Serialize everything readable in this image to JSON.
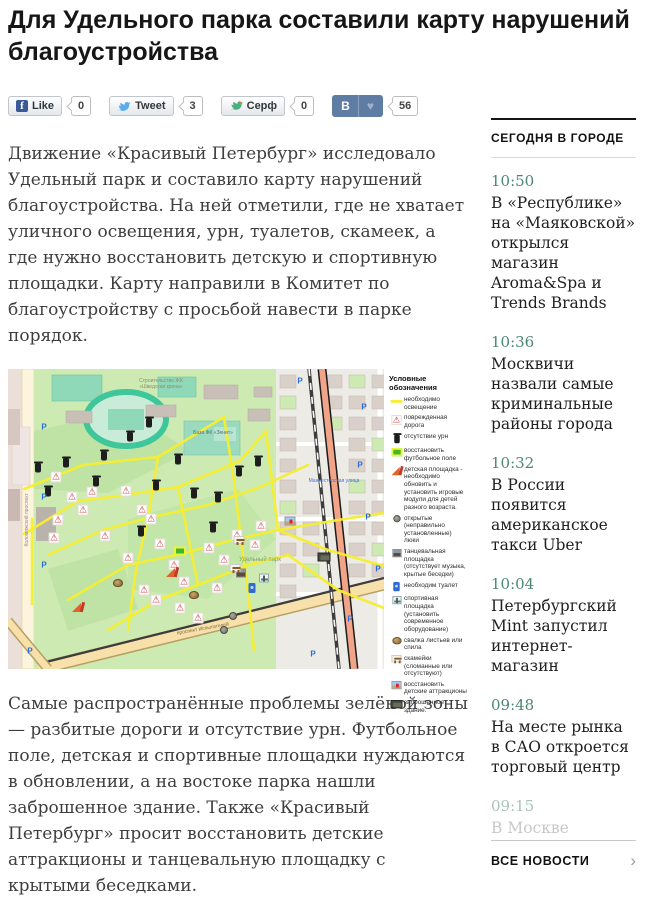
{
  "page": {
    "title": "Для Удельного парка составили карту нарушений благоустройства"
  },
  "share": {
    "facebook": {
      "label": "Like",
      "count": "0"
    },
    "twitter": {
      "label": "Tweet",
      "count": "3"
    },
    "surfingbird": {
      "label": "Серф",
      "count": "0"
    },
    "vk": {
      "label": "В",
      "count": "56"
    }
  },
  "article": {
    "paragraph_1": "Движение «Красивый Петербург» исследовало Удельный парк и составило карту нарушений благоустройства. На ней отметили, где не хватает уличного освещения, урн, туалетов, скамеек, а где нужно восстановить детскую и спортивную площадки. Карту направили в Комитет по благоустройству с просьбой навести в парке порядок.",
    "paragraph_2": "Самые распространённые проблемы зелёной зоны — разбитые дороги и отсутствие урн. Футбольное поле, детская и спортивные площадки нуждаются в обновлении, а на востоке парка нашли заброшенное здание. Также «Красивый Петербург» просит восстановить детские аттракционы и танцевальную площадку с крытыми беседками."
  },
  "map": {
    "legend_title": "Условные обозначения",
    "legend": [
      {
        "icon": "light",
        "label": "необходимо освещение"
      },
      {
        "icon": "road",
        "label": "поврежденная дорога"
      },
      {
        "icon": "urn",
        "label": "отсутствие урн"
      },
      {
        "icon": "football",
        "label": "восстановить футбольное поле"
      },
      {
        "icon": "playground",
        "label": "детская площадка - необходимо обновить и установить игровые модули для детей разного возраста."
      },
      {
        "icon": "manhole",
        "label": "открытые (неправильно установленные) люки"
      },
      {
        "icon": "dance",
        "label": "танцевальная площадка (отсутствует музыка, крытые беседки)"
      },
      {
        "icon": "toilet",
        "label": "необходим туалет"
      },
      {
        "icon": "sport",
        "label": "спортивная площадка (установить современное оборудование)"
      },
      {
        "icon": "leaves",
        "label": "свалка листьев или спила"
      },
      {
        "icon": "bench",
        "label": "скамейки (сломанные или отсутствуют)"
      },
      {
        "icon": "attraction",
        "label": "восстановить детские аттракционы"
      },
      {
        "icon": "abandoned",
        "label": "заброшенное здание."
      }
    ],
    "labels": [
      {
        "text": "Строительство ЖК «Шведская крона»",
        "x": 118,
        "y": 10,
        "w": 70,
        "size": 5,
        "color": "#8f8c70",
        "rotate": 0
      },
      {
        "text": "База ФК «Зенит»",
        "x": 180,
        "y": 62,
        "w": 50,
        "size": 5,
        "color": "#5a6a7a",
        "rotate": 0
      },
      {
        "text": "Удельный парк",
        "x": 226,
        "y": 188,
        "w": 52,
        "size": 6,
        "color": "#7f9f72",
        "rotate": 0
      },
      {
        "text": "Коломяжский проспект",
        "x": -30,
        "y": 148,
        "w": 100,
        "size": 5,
        "color": "#9a8aa5",
        "rotate": -90
      },
      {
        "text": "проспект Испытателей",
        "x": 150,
        "y": 258,
        "w": 90,
        "size": 5,
        "color": "#7a6a40",
        "rotate": -10
      },
      {
        "text": "Манчестерская улица",
        "x": 284,
        "y": 110,
        "w": 84,
        "size": 5,
        "color": "#4a6fd4",
        "rotate": 0
      }
    ],
    "parking": {
      "glyph": "P",
      "positions": [
        {
          "x": 36,
          "y": 58
        },
        {
          "x": 36,
          "y": 128
        },
        {
          "x": 36,
          "y": 196
        },
        {
          "x": 22,
          "y": 282
        },
        {
          "x": 292,
          "y": 12
        },
        {
          "x": 356,
          "y": 38
        },
        {
          "x": 352,
          "y": 96
        },
        {
          "x": 360,
          "y": 148
        },
        {
          "x": 342,
          "y": 250
        },
        {
          "x": 305,
          "y": 285
        },
        {
          "x": 370,
          "y": 200
        }
      ]
    },
    "light_paths": [
      "16,120 75,96 150,88 216,48",
      "16,165 70,132 118,126 170,118 232,92 258,62",
      "40,186 95,161 140,149 200,136 250,119 300,96",
      "60,231 120,196 168,186 225,171 270,161 330,151 376,144",
      "100,261 150,231 190,216 240,196 280,186",
      "150,88 140,149 128,201 120,261",
      "216,48 226,111 233,171 241,231 246,281",
      "170,118 190,216",
      "258,62 270,161",
      "280,186 330,221 376,239",
      "270,161 320,181 376,197",
      "24,150 24,235"
    ],
    "markers": [
      {
        "t": "road",
        "x": 48,
        "y": 108
      },
      {
        "t": "road",
        "x": 64,
        "y": 128
      },
      {
        "t": "road",
        "x": 84,
        "y": 123
      },
      {
        "t": "road",
        "x": 75,
        "y": 141
      },
      {
        "t": "road",
        "x": 50,
        "y": 151
      },
      {
        "t": "road",
        "x": 46,
        "y": 169
      },
      {
        "t": "road",
        "x": 118,
        "y": 122
      },
      {
        "t": "road",
        "x": 134,
        "y": 141
      },
      {
        "t": "road",
        "x": 143,
        "y": 150
      },
      {
        "t": "road",
        "x": 97,
        "y": 167
      },
      {
        "t": "road",
        "x": 152,
        "y": 175
      },
      {
        "t": "road",
        "x": 120,
        "y": 189
      },
      {
        "t": "road",
        "x": 166,
        "y": 196
      },
      {
        "t": "road",
        "x": 176,
        "y": 213
      },
      {
        "t": "road",
        "x": 136,
        "y": 221
      },
      {
        "t": "road",
        "x": 201,
        "y": 179
      },
      {
        "t": "road",
        "x": 216,
        "y": 191
      },
      {
        "t": "road",
        "x": 229,
        "y": 166
      },
      {
        "t": "road",
        "x": 247,
        "y": 176
      },
      {
        "t": "road",
        "x": 253,
        "y": 157
      },
      {
        "t": "road",
        "x": 209,
        "y": 219
      },
      {
        "t": "road",
        "x": 190,
        "y": 249
      },
      {
        "t": "road",
        "x": 172,
        "y": 239
      },
      {
        "t": "road",
        "x": 148,
        "y": 231
      },
      {
        "t": "urn",
        "x": 30,
        "y": 97
      },
      {
        "t": "urn",
        "x": 58,
        "y": 92
      },
      {
        "t": "urn",
        "x": 96,
        "y": 85
      },
      {
        "t": "urn",
        "x": 40,
        "y": 121
      },
      {
        "t": "urn",
        "x": 88,
        "y": 111
      },
      {
        "t": "urn",
        "x": 122,
        "y": 66
      },
      {
        "t": "urn",
        "x": 141,
        "y": 52
      },
      {
        "t": "urn",
        "x": 170,
        "y": 89
      },
      {
        "t": "urn",
        "x": 148,
        "y": 115
      },
      {
        "t": "urn",
        "x": 186,
        "y": 123
      },
      {
        "t": "urn",
        "x": 210,
        "y": 127
      },
      {
        "t": "urn",
        "x": 231,
        "y": 101
      },
      {
        "t": "urn",
        "x": 250,
        "y": 91
      },
      {
        "t": "urn",
        "x": 205,
        "y": 157
      },
      {
        "t": "urn",
        "x": 133,
        "y": 161
      },
      {
        "t": "football",
        "x": 172,
        "y": 182
      },
      {
        "t": "playground",
        "x": 164,
        "y": 203
      },
      {
        "t": "playground",
        "x": 70,
        "y": 238
      },
      {
        "t": "manhole",
        "x": 225,
        "y": 247
      },
      {
        "t": "manhole",
        "x": 216,
        "y": 261
      },
      {
        "t": "dance",
        "x": 233,
        "y": 204
      },
      {
        "t": "toilet",
        "x": 244,
        "y": 219
      },
      {
        "t": "sport",
        "x": 256,
        "y": 209
      },
      {
        "t": "leaves",
        "x": 110,
        "y": 214
      },
      {
        "t": "leaves",
        "x": 186,
        "y": 226
      },
      {
        "t": "bench",
        "x": 227,
        "y": 199
      },
      {
        "t": "bench",
        "x": 231,
        "y": 171
      },
      {
        "t": "attraction",
        "x": 282,
        "y": 152
      },
      {
        "t": "abandoned",
        "x": 316,
        "y": 188
      }
    ]
  },
  "sidebar": {
    "heading": "СЕГОДНЯ В ГОРОДЕ",
    "items": [
      {
        "time": "10:50",
        "text": "В «Республике» на «Маяковской» открылся магазин Aroma&Spa и Trends Brands"
      },
      {
        "time": "10:36",
        "text": "Москвичи назвали самые криминальные районы города"
      },
      {
        "time": "10:32",
        "text": "В России появится американское такси Uber"
      },
      {
        "time": "10:04",
        "text": "Петербургский Mint запустил интернет-магазин"
      },
      {
        "time": "09:48",
        "text": "На месте рынка в САО откроется торговый центр"
      },
      {
        "time": "09:15",
        "text": "В Москве",
        "faded": true
      }
    ],
    "all_news_label": "ВСЕ НОВОСТИ"
  },
  "colors": {
    "accent_teal": "#4d8674",
    "vk_blue": "#5f7da4",
    "facebook_blue": "#3b5998",
    "twitter_blue": "#59adeb",
    "surf_green": "#4aaf7e",
    "highlight_yellow": "#f5ee2e"
  }
}
